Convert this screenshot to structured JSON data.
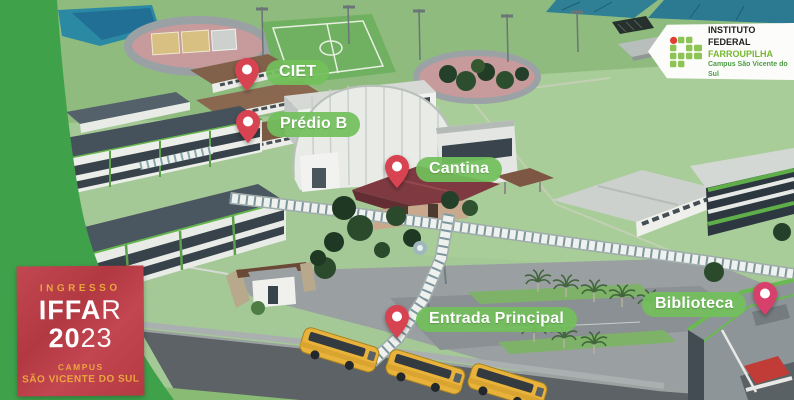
{
  "colors": {
    "accent_label_green": "#72bf5b",
    "pin_red": "#d84352",
    "badge_red": "#bf3c47",
    "side_band_green": "#3fa24b",
    "logo_green": "#8dc455",
    "logo_red": "#e23b34",
    "badge_gold": "#eba53e"
  },
  "pins": [
    {
      "id": "ciet",
      "label": "CIET"
    },
    {
      "id": "predio-b",
      "label": "Prédio B"
    },
    {
      "id": "cantina",
      "label": "Cantina"
    },
    {
      "id": "entrada-principal",
      "label": "Entrada Principal"
    },
    {
      "id": "biblioteca",
      "label": "Biblioteca"
    }
  ],
  "logo_banner": {
    "line1": "INSTITUTO FEDERAL",
    "line2": "FARROUPILHA",
    "line3": "Campus São Vicente do Sul"
  },
  "badge": {
    "top": "INGRESSO",
    "brand_bold": "IFFA",
    "brand_light": "R",
    "year_bold": "20",
    "year_light": "23",
    "campus_label": "CAMPUS",
    "campus_name": "SÃO VICENTE DO SUL"
  }
}
